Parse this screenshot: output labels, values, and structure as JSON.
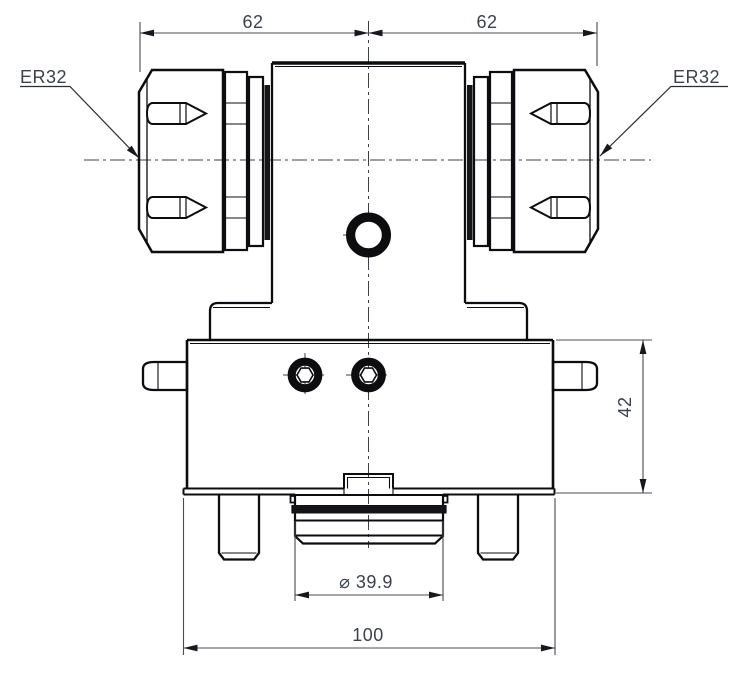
{
  "drawing": {
    "view": "front-view-technical-drawing",
    "labels": {
      "collet_left": "ER32",
      "collet_right": "ER32"
    },
    "dimensions": {
      "top_left_width": "62",
      "top_right_width": "62",
      "body_height": "42",
      "boss_diameter": "⌀ 39.9",
      "overall_width": "100"
    },
    "colors": {
      "background": "#ffffff",
      "object_lines": "#0c0d10",
      "dimension_lines": "#4a4c53",
      "dimension_text": "#3b424e",
      "centerlines": "#3c3f46"
    }
  }
}
